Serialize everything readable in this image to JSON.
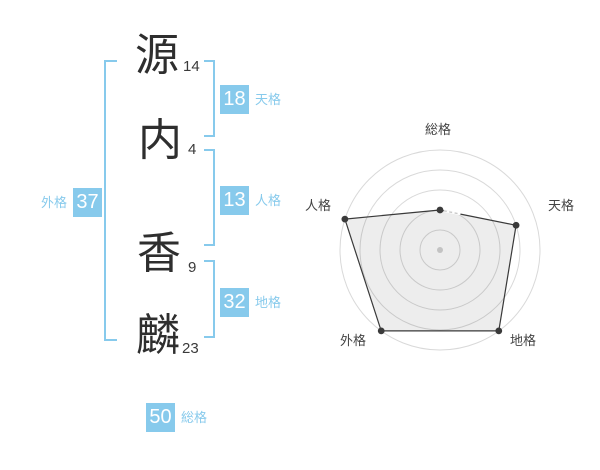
{
  "colors": {
    "accent_blue": "#87caec",
    "badge_text": "#ffffff",
    "kanji_ink": "#2e2e2e",
    "radar_line": "#3a3a3a",
    "radar_grid": "#d9d9d9",
    "radar_fill": "rgba(0,0,0,0.07)",
    "radar_center_dot": "#c3c3c3"
  },
  "name": {
    "characters": [
      {
        "char": "源",
        "strokes": "14"
      },
      {
        "char": "内",
        "strokes": "4"
      },
      {
        "char": "香",
        "strokes": "9"
      },
      {
        "char": "麟",
        "strokes": "23"
      }
    ]
  },
  "kaku": {
    "tenkaku": {
      "value": "18",
      "label": "天格"
    },
    "jinkaku": {
      "value": "13",
      "label": "人格"
    },
    "chikaku": {
      "value": "32",
      "label": "地格"
    },
    "gaikaku": {
      "value": "37",
      "label": "外格"
    },
    "soukaku": {
      "value": "50",
      "label": "総格"
    }
  },
  "chart_data": {
    "type": "radar",
    "categories": [
      "総格",
      "天格",
      "地格",
      "外格",
      "人格"
    ],
    "values": [
      2,
      4,
      5,
      5,
      5
    ],
    "max": 5,
    "rings": 5,
    "start_angle_deg": -90,
    "direction": "clockwise",
    "grid": "circular",
    "legend_position": "none"
  }
}
